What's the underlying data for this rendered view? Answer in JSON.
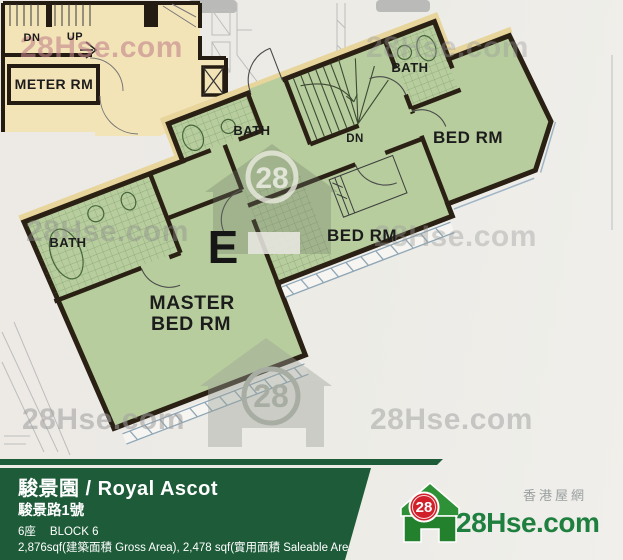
{
  "colors": {
    "unit_green": "#b7cd9d",
    "common_beige": "#f3e4b8",
    "wall_dark": "#2a2014",
    "footer_bar_green": "#1d5b39",
    "brand_green": "#1e7f3f",
    "brand_red": "#d2202a",
    "watermark_gray": "#9c9c9c"
  },
  "plan": {
    "unit_letter": "E",
    "labels": {
      "master_line1": "MASTER",
      "master_line2": "BED RM",
      "bed_rm": "BED RM",
      "bath": "BATH",
      "dn": "DN",
      "up": "UP",
      "meter_rm": "METER RM"
    }
  },
  "watermark": {
    "text": "28Hse.com",
    "badge": "28"
  },
  "footer": {
    "estate": "駿景園 / Royal Ascot",
    "address": "駿景路1號",
    "block_cn": "6座",
    "block_en": "BLOCK 6",
    "area": "2,876sqf(建築面積 Gross Area), 2,478 sqf(實用面積 Saleable Area)"
  },
  "logo": {
    "site": "28Hse.com",
    "tagline": "香港屋網",
    "badge": "28"
  }
}
